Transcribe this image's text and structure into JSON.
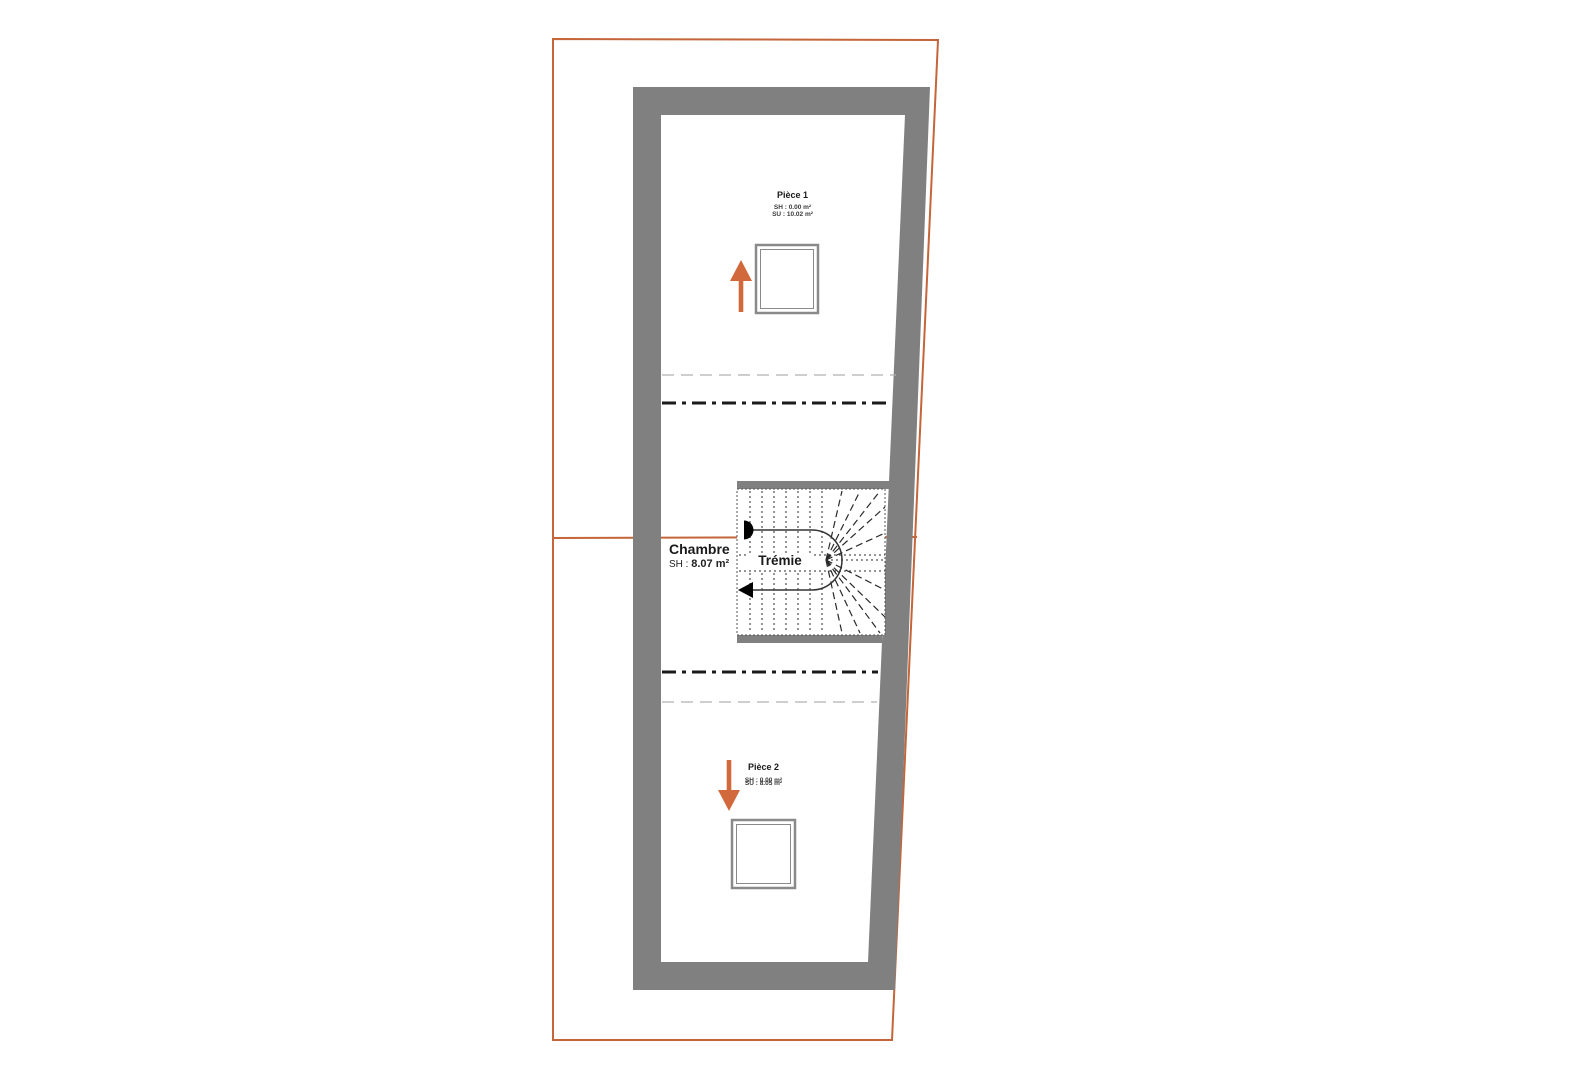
{
  "drawing": {
    "kind": "architectural floor plan",
    "colors": {
      "parcel_boundary": "#c4653a",
      "walls": "#808080",
      "arrow": "#d2693c",
      "heavy_dashdot": "#1a1a1a",
      "thin_dash": "#b0b0b0",
      "stair_lines": "#2a2a2a"
    },
    "rooms": {
      "piece1": {
        "name": "Pièce 1",
        "sh": "SH : 0.00 m²",
        "su": "SU : 10.02 m²"
      },
      "chambre": {
        "name": "Chambre",
        "sh_label": "SH :",
        "sh_value": "8.07 m²"
      },
      "tremie": {
        "name": "Trémie"
      },
      "piece2": {
        "name": "Pièce 2",
        "sh": "SH : 0.00 m²",
        "su": "SU : 8.05 m²"
      }
    }
  }
}
